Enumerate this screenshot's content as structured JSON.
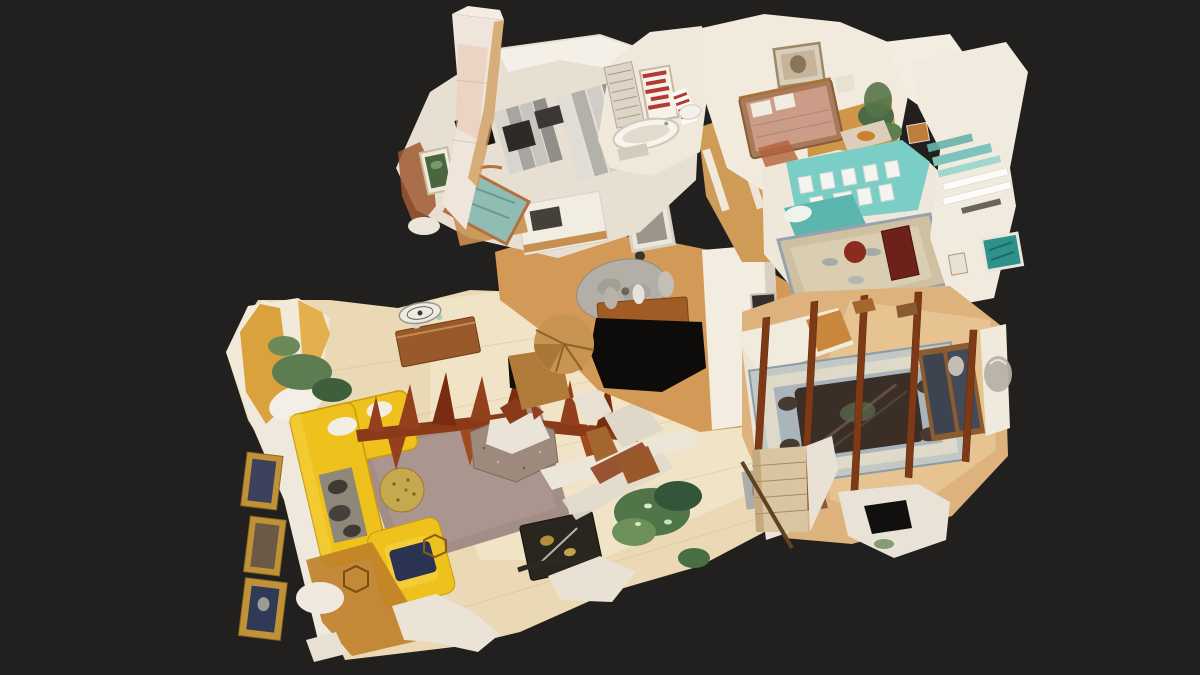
{
  "viewer": {
    "type": "3d-dollhouse-view",
    "description": "Overhead 3D dollhouse scan of an apartment: living room with yellow sectional, entry hall, kitchen, bathroom, bedroom, teal home office, dining room and stair, floating on a dark viewer background",
    "background": "#22201e"
  },
  "palette": {
    "background": "#22201e",
    "floor_parquet": "#ead9b4",
    "floor_oak": "#d29a56",
    "wall_white": "#efe9dd",
    "sofa_yellow": "#eec11d",
    "rug_taupe": "#a28d87",
    "rug_blue_gray": "#a9b5bb",
    "accent_teal": "#7bcec5",
    "artifact_rust": "#8a3a18",
    "bed_salmon": "#cb9d89",
    "plant_green": "#4f7549",
    "frame_gold": "#c09238",
    "scan_void": "#0e0c0a"
  },
  "rooms": [
    {
      "id": "living-room",
      "label": "Living room"
    },
    {
      "id": "entry-hall",
      "label": "Entry hall"
    },
    {
      "id": "kitchen",
      "label": "Kitchen"
    },
    {
      "id": "bathroom",
      "label": "Bathroom"
    },
    {
      "id": "bedroom",
      "label": "Bedroom"
    },
    {
      "id": "home-office",
      "label": "Home office"
    },
    {
      "id": "dining-room",
      "label": "Dining room"
    },
    {
      "id": "stairwell",
      "label": "Stairwell"
    }
  ]
}
